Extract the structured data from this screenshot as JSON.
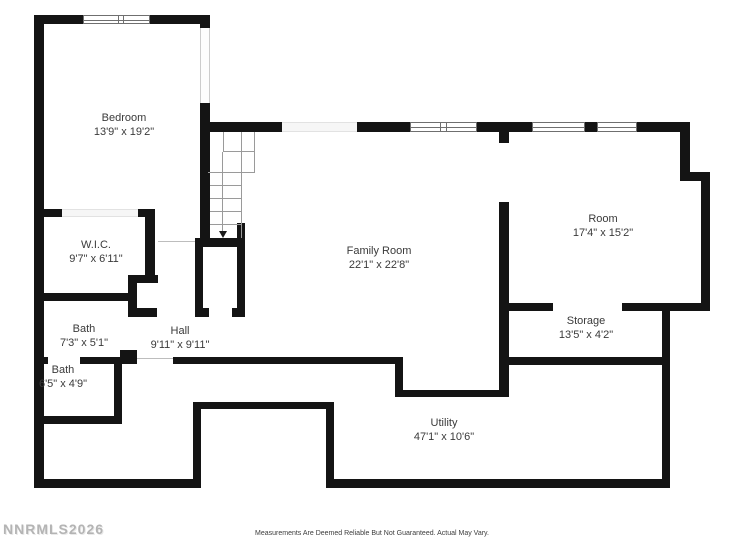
{
  "floorplan": {
    "rooms": [
      {
        "id": "bedroom",
        "name": "Bedroom",
        "dims": "13'9\" x 19'2\""
      },
      {
        "id": "wic",
        "name": "W.I.C.",
        "dims": "9'7\" x 6'11\""
      },
      {
        "id": "bath-1",
        "name": "Bath",
        "dims": "7'3\" x 5'1\""
      },
      {
        "id": "bath-2",
        "name": "Bath",
        "dims": "6'5\" x 4'9\""
      },
      {
        "id": "hall",
        "name": "Hall",
        "dims": "9'11\" x 9'11\""
      },
      {
        "id": "family",
        "name": "Family Room",
        "dims": "22'1\" x 22'8\""
      },
      {
        "id": "room",
        "name": "Room",
        "dims": "17'4\" x 15'2\""
      },
      {
        "id": "storage",
        "name": "Storage",
        "dims": "13'5\" x 4'2\""
      },
      {
        "id": "utility",
        "name": "Utility",
        "dims": "47'1\" x 10'6\""
      }
    ],
    "watermark": "NNRMLS2026",
    "disclaimer": "Measurements Are Deemed Reliable But Not Guaranteed. Actual May Vary.",
    "stairs": {
      "direction": "down"
    },
    "colors": {
      "wall": "#141414",
      "text": "#3a3a3a",
      "watermark": "#b4b4b4",
      "background": "#ffffff"
    }
  }
}
